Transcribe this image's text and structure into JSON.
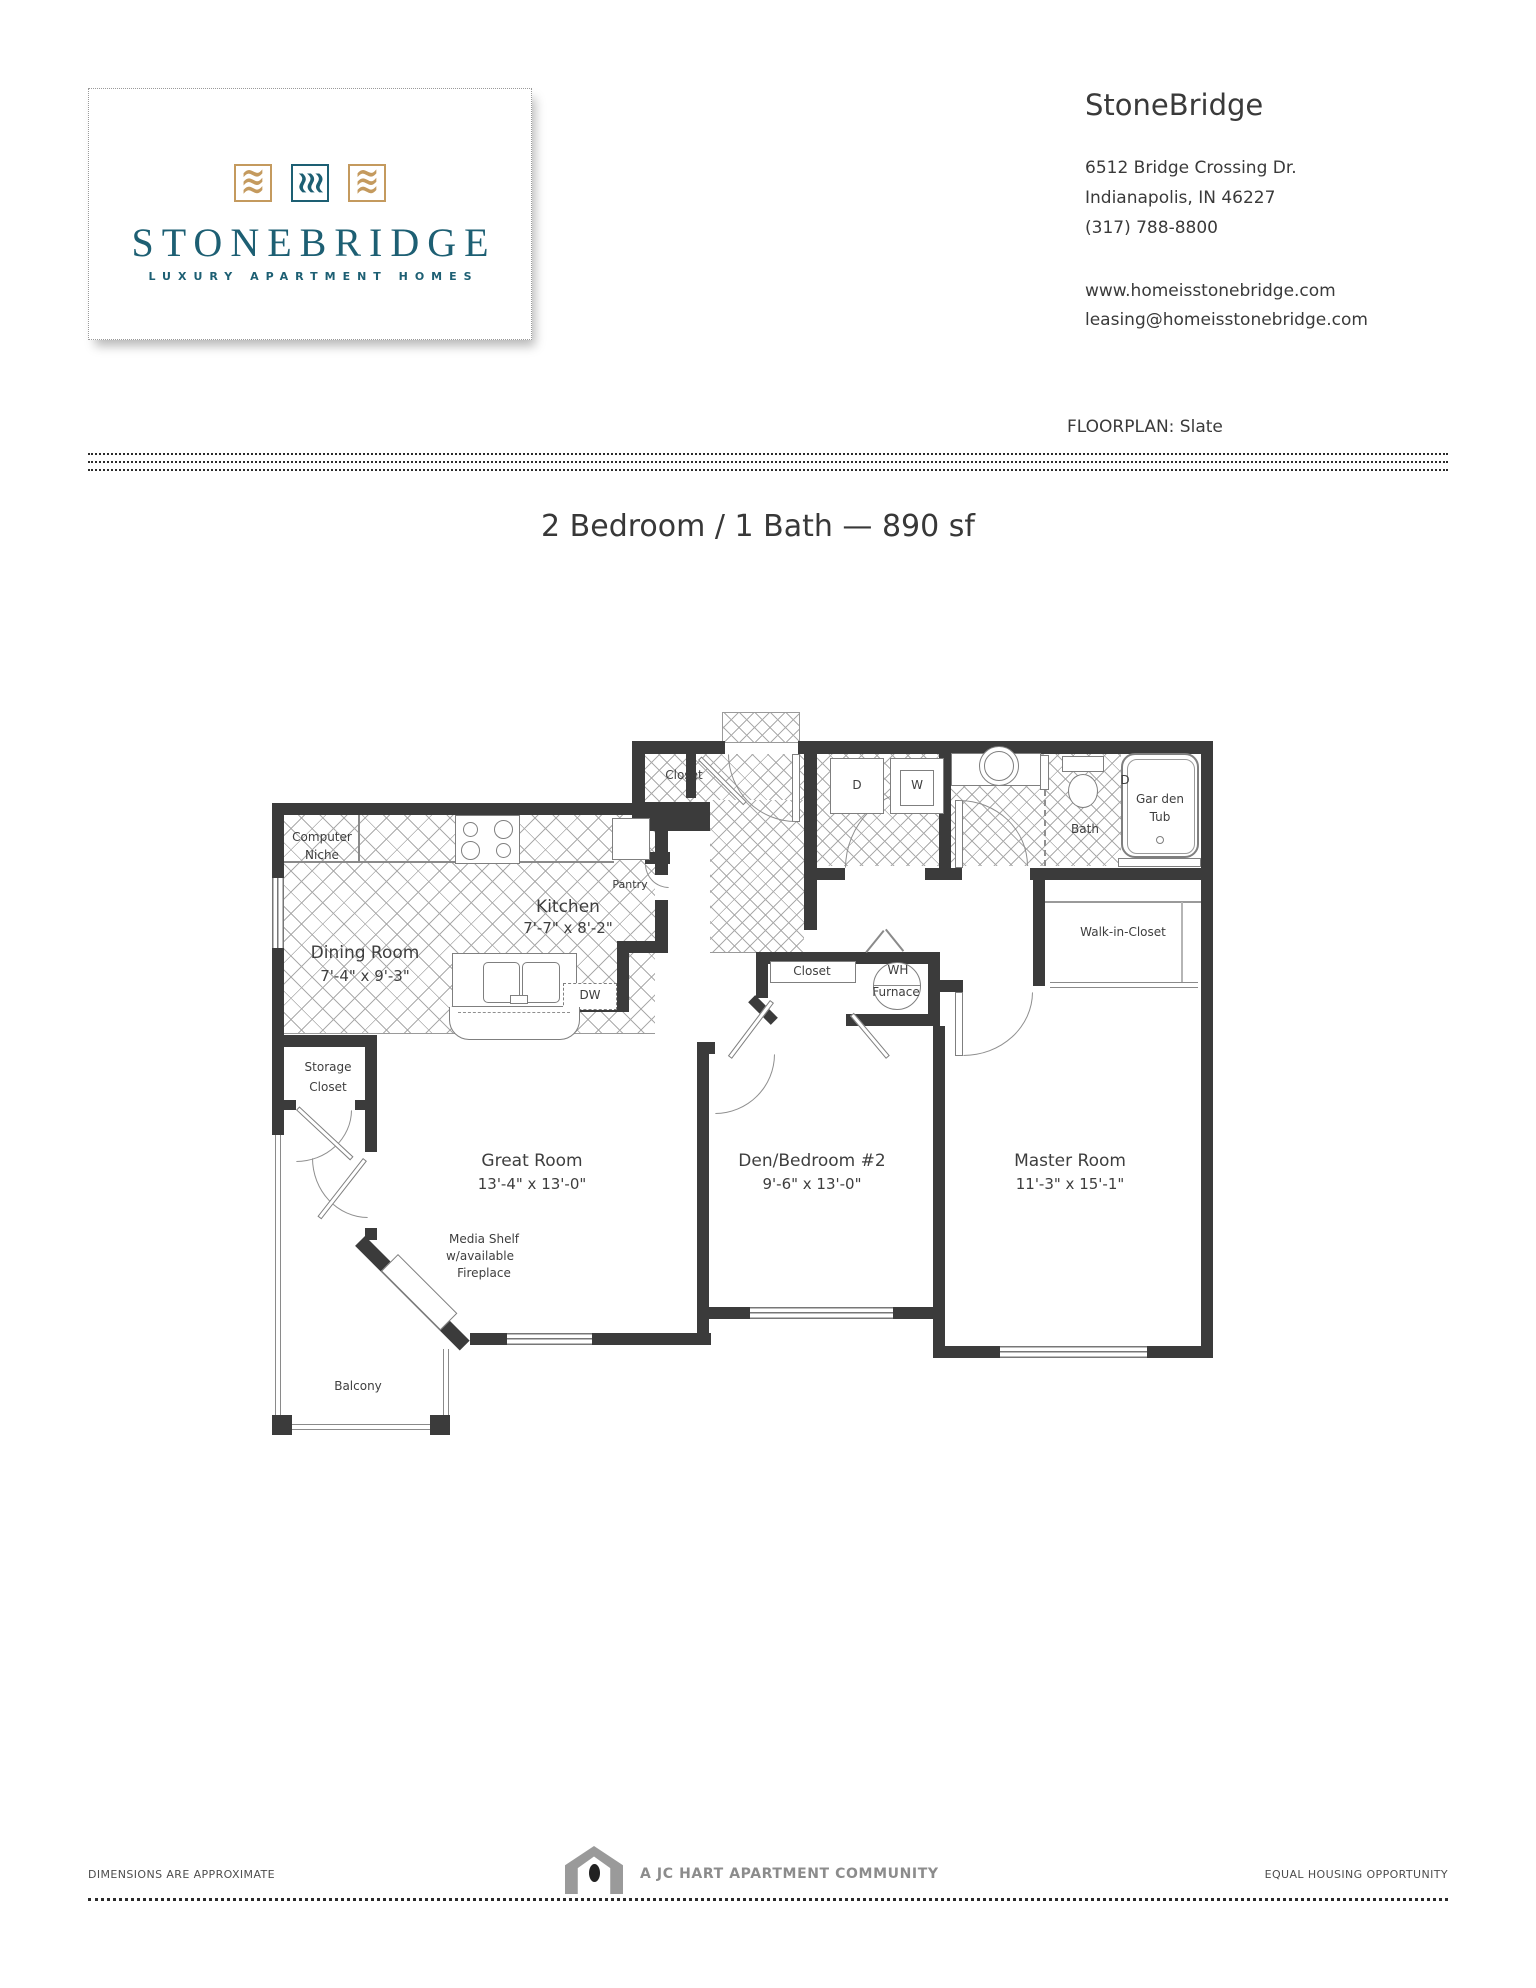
{
  "logo": {
    "name": "STONEBRIDGE",
    "tagline": "LUXURY APARTMENT HOMES"
  },
  "property": {
    "name": "StoneBridge",
    "address_line1": "6512 Bridge Crossing Dr.",
    "address_line2": "Indianapolis, IN 46227",
    "phone": "(317) 788-8800",
    "website": "www.homeisstonebridge.com",
    "email": "leasing@homeisstonebridge.com"
  },
  "floorplan": {
    "label": "FLOORPLAN: Slate",
    "title": "2 Bedroom / 1 Bath — 890 sf"
  },
  "rooms": {
    "dining": {
      "name": "Dining Room",
      "dims": "7'-4\" x 9'-3\""
    },
    "kitchen": {
      "name": "Kitchen",
      "dims": "7'-7\" x 8'-2\""
    },
    "great": {
      "name": "Great Room",
      "dims": "13'-4\" x 13'-0\""
    },
    "den": {
      "name": "Den/Bedroom #2",
      "dims": "9'-6\" x 13'-0\""
    },
    "master": {
      "name": "Master Room",
      "dims": "11'-3\" x 15'-1\""
    }
  },
  "labels": {
    "computer_niche_1": "Computer",
    "computer_niche_2": "Niche",
    "pantry": "Pantry",
    "entry_closet": "Closet",
    "den_closet": "Closet",
    "storage_1": "Storage",
    "storage_2": "Closet",
    "wh_1": "WH",
    "wh_2": "Furnace",
    "walk_in_closet": "Walk-in-Closet",
    "bath": "Bath",
    "tub_1": "Gar den",
    "tub_2": "Tub",
    "dryer": "D",
    "washer": "W",
    "dishwasher": "DW",
    "media_1": "Media Shelf",
    "media_2": "w/available",
    "media_3": "Fireplace",
    "balcony": "Balcony"
  },
  "footer": {
    "note": "DIMENSIONS ARE APPROXIMATE",
    "community": "A JC HART APARTMENT COMMUNITY",
    "eho": "EQUAL HOUSING OPPORTUNITY"
  },
  "colors": {
    "teal": "#1d5f73",
    "gold": "#c49a5e",
    "wall": "#3b3b3b"
  }
}
